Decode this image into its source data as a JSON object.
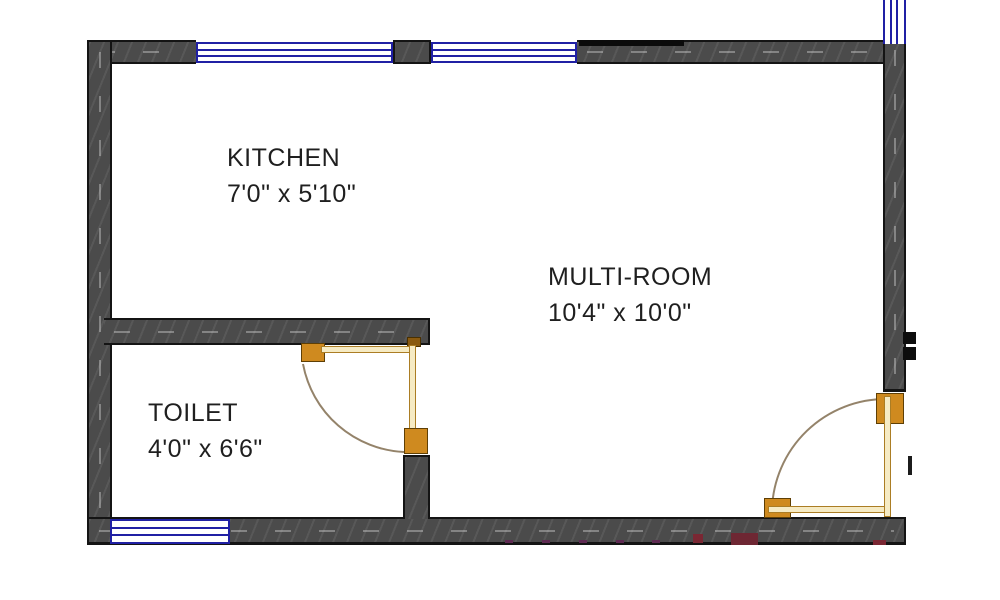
{
  "plan": {
    "rooms": {
      "kitchen": {
        "name": "KITCHEN",
        "dimensions": "7'0\" x 5'10\""
      },
      "multi_room": {
        "name": "MULTI-ROOM",
        "dimensions": "10'4\" x 10'0\""
      },
      "toilet": {
        "name": "TOILET",
        "dimensions": "4'0\" x 6'6\""
      }
    },
    "colors": {
      "background": "#ffffff",
      "wall_fill": "#4b4b4b",
      "wall_outline": "#141414",
      "window_blue": "#2020a4",
      "door_hardware_orange": "#cf8a1f",
      "door_leaf_fill": "#f6ebc4",
      "door_leaf_edge": "#ab7d24",
      "swing_arc_tan": "#94836a",
      "accent_red_marks": "#7a2733",
      "label_text": "#1f1f1f"
    }
  }
}
